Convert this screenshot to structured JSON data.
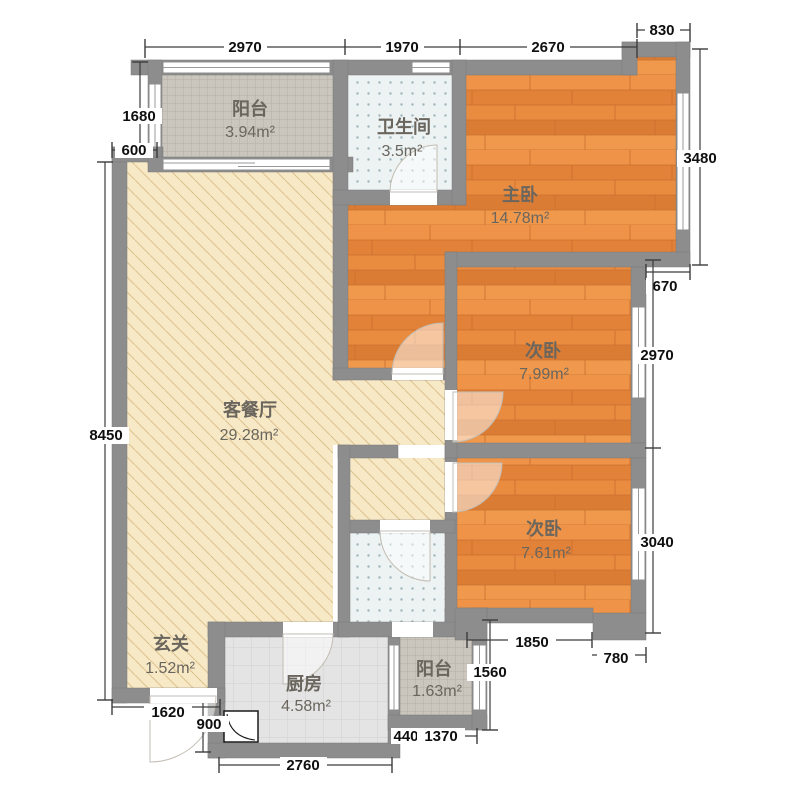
{
  "palette": {
    "wall": "#8d8d8d",
    "wood_floor": "#e8873c",
    "wood_seam": "#c96f2e",
    "living_floor": "#f7e9c6",
    "living_hatch": "#dcc18e",
    "balcony_tile": "#cac6be",
    "balcony_tile_line": "#b4b0a7",
    "bath_tile": "#edf2f2",
    "bath_dot": "#9fb4ba",
    "kitchen_tile": "#e4e4e4",
    "kitchen_line": "#d1d1d1",
    "dim_text": "#0f0f0f",
    "room_text": "#6a665e"
  },
  "rooms": {
    "balcony_top": {
      "name": "阳台",
      "area": "3.94m²"
    },
    "bath_top": {
      "name": "卫生间",
      "area": "3.5m²"
    },
    "master": {
      "name": "主卧",
      "area": "14.78m²"
    },
    "bed2": {
      "name": "次卧",
      "area": "7.99m²"
    },
    "bed3": {
      "name": "次卧",
      "area": "7.61m²"
    },
    "living": {
      "name": "客餐厅",
      "area": "29.28m²"
    },
    "entry": {
      "name": "玄关",
      "area": "1.52m²"
    },
    "kitchen": {
      "name": "厨房",
      "area": "4.58m²"
    },
    "balcony_bottom": {
      "name": "阳台",
      "area": "1.63m²"
    }
  },
  "dims": {
    "top": {
      "d1": "2970",
      "d2": "1970",
      "d3": "2670",
      "d4": "830"
    },
    "left": {
      "d1": "1680",
      "d2": "600",
      "d3": "8450"
    },
    "right": {
      "d1": "3480",
      "d2": "670",
      "d3": "2970",
      "d4": "3040"
    },
    "bottom": {
      "d1": "1620",
      "d2": "900",
      "d3": "2760",
      "d4": "440",
      "d5": "1370",
      "d6": "1850",
      "d7": "780",
      "d8": "1560"
    }
  }
}
